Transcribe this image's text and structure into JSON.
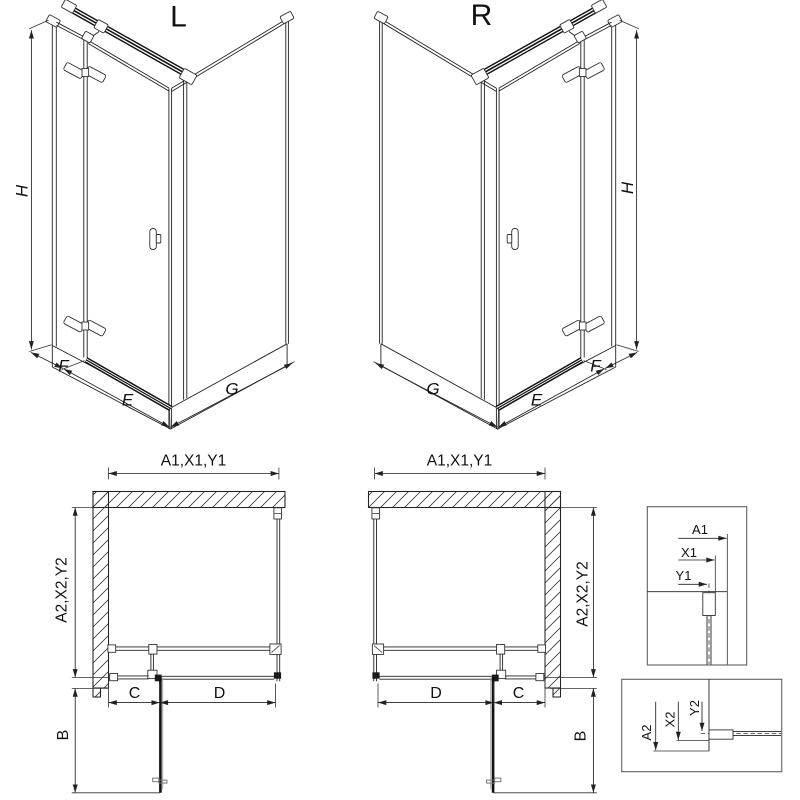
{
  "iso_left": {
    "title": "L",
    "dim_height": "H",
    "dim_fixed": "F",
    "dim_door": "E",
    "dim_side": "G"
  },
  "iso_right": {
    "title": "R",
    "dim_height": "H",
    "dim_fixed": "F",
    "dim_door": "E",
    "dim_side": "G"
  },
  "plan_left": {
    "dim_width": "A1,X1,Y1",
    "dim_depth": "A2,X2,Y2",
    "dim_c": "C",
    "dim_d": "D",
    "dim_b": "B"
  },
  "plan_right": {
    "dim_width": "A1,X1,Y1",
    "dim_depth": "A2,X2,Y2",
    "dim_c": "C",
    "dim_d": "D",
    "dim_b": "B"
  },
  "detail_top": {
    "dim_a1": "A1",
    "dim_x1": "X1",
    "dim_y1": "Y1"
  },
  "detail_bottom": {
    "dim_a2": "A2",
    "dim_x2": "X2",
    "dim_y2": "Y2"
  },
  "colors": {
    "line": "#222222",
    "fitting_gray": "#555555",
    "box_border": "#666666",
    "background": "#ffffff"
  }
}
